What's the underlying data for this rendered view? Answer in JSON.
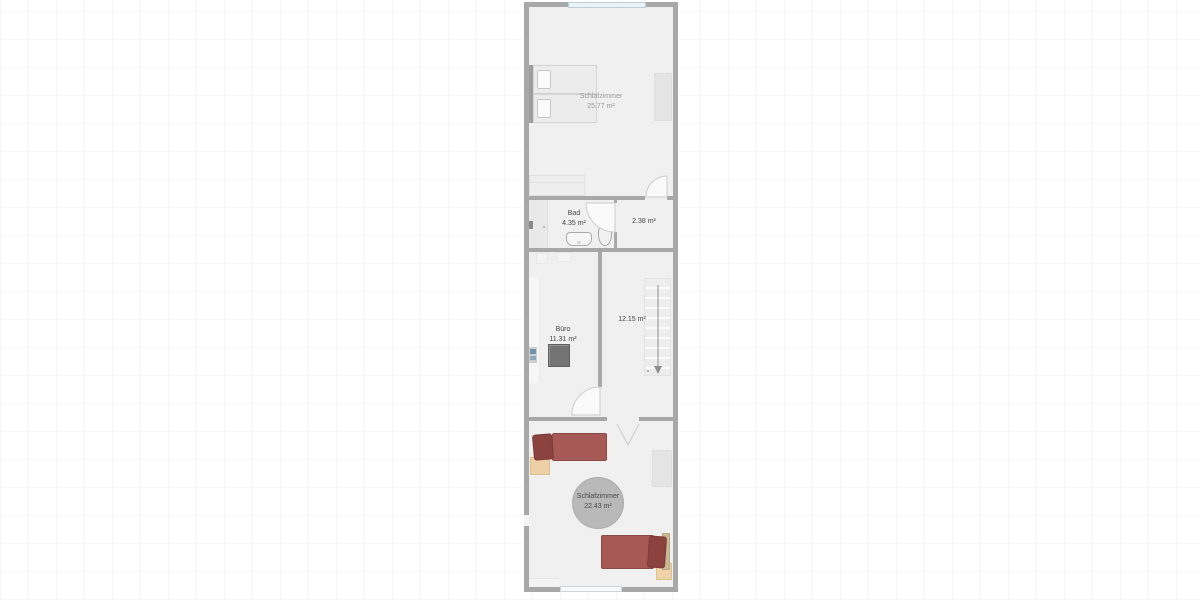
{
  "rooms": {
    "bedroom_top": {
      "name": "Schlafzimmer",
      "area": "25.77 m²"
    },
    "bath": {
      "name": "Bad",
      "area": "4.35 m²"
    },
    "hall": {
      "area": "2.38 m²"
    },
    "office": {
      "name": "Büro",
      "area": "11.31 m²"
    },
    "staircase": {
      "area": "12.15 m²"
    },
    "bedroom_bottom": {
      "name": "Schlafzimmer",
      "area": "22.43 m²"
    }
  },
  "colors": {
    "wall": "#a8a8a8",
    "floor": "#f0f0f0",
    "window": "#e8f3f8",
    "bed_red": "#a65955",
    "pillow_red": "#8c4340",
    "nightstand": "#edd0a6",
    "rug": "#b9b9b9",
    "desk": "#747474",
    "accent_blue": "#6d93ad",
    "label_dark": "#45474a",
    "label_light": "#97999b"
  }
}
